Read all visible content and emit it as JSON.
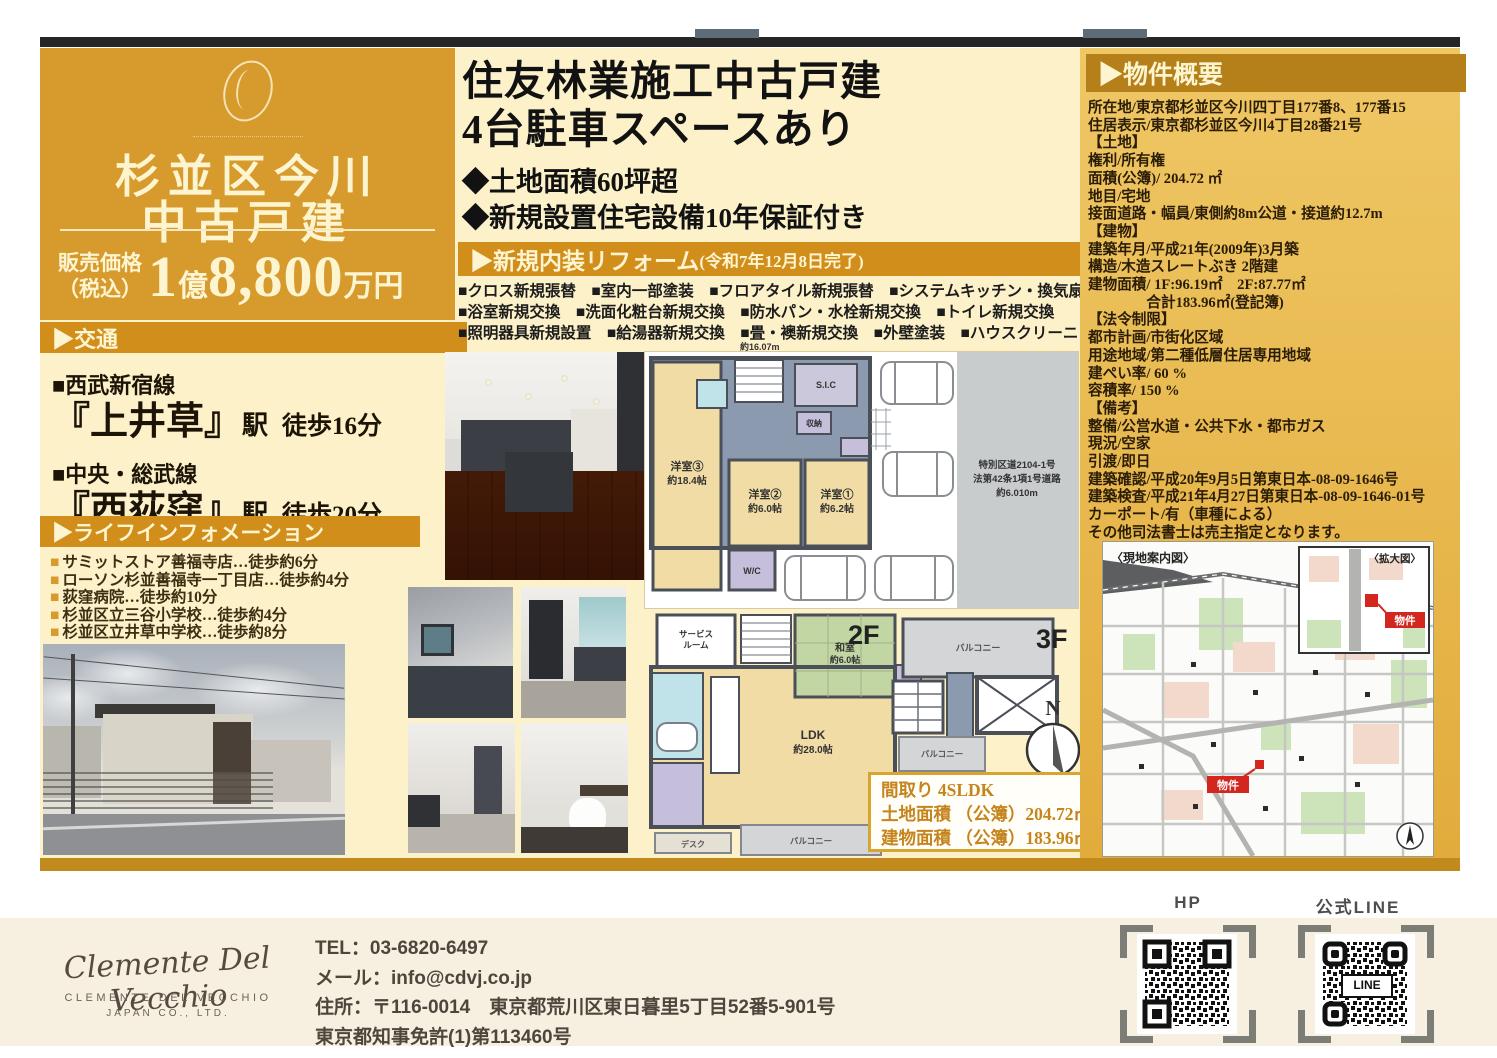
{
  "accent": {
    "gold_panel": "#d69a2d",
    "gold_bar": "#d18e1b",
    "gold_dark_bar": "#b5801a",
    "cream_bg": "#fcf1c8",
    "footer_bg": "#f7f0e1",
    "marker_red": "#d2261e"
  },
  "left": {
    "title_line1": "杉並区今川",
    "title_line2": "中古戸建",
    "price_label_1": "販売価格",
    "price_label_2": "（税込）",
    "price_num1": "1",
    "price_oku": "億",
    "price_num2": "8,800",
    "price_man": "万円",
    "traffic_header": "▶交通",
    "traffic": [
      {
        "line": "■西武新宿線",
        "station": "『上井草』",
        "suffix": "駅",
        "walk": "徒歩16分"
      },
      {
        "line": "■中央・総武線",
        "station": "『西荻窪』",
        "suffix": "駅",
        "walk": "徒歩20分"
      }
    ],
    "life_header": "▶ライフインフォメーション",
    "bullet": "■",
    "life_items": [
      "サミットストア善福寺店…徒歩約6分",
      "ローソン杉並善福寺一丁目店…徒歩約4分",
      "荻窪病院…徒歩約10分",
      "杉並区立三谷小学校…徒歩約4分",
      "杉並区立井草中学校…徒歩約8分"
    ]
  },
  "center": {
    "title1": "住友林業施工中古戸建",
    "title2": "4台駐車スペースあり",
    "point1": "◆土地面積60坪超",
    "point2": "◆新規設置住宅設備10年保証付き",
    "reform_header": "▶新規内装リフォーム",
    "reform_header_sub": "(令和7年12月8日完了)",
    "reform_lines": [
      "■クロス新規張替　■室内一部塗装　■フロアタイル新規張替　■システムキッチン・換気扇新規交換",
      "■浴室新規交換　■洗面化粧台新規交換　■防水パン・水栓新規交換　■トイレ新規交換",
      "■照明器具新規設置　■給湯器新規交換　■畳・襖新規交換　■外壁塗装　■ハウスクリーニング等"
    ],
    "plan1f": {
      "top_dim": "約16.07m",
      "room3": "洋室③",
      "room3_size": "約18.4帖",
      "room2": "洋室②",
      "room2_size": "約6.0帖",
      "room1": "洋室①",
      "room1_size": "約6.2帖",
      "wc": "W/C",
      "sic": "S.I.C",
      "closet": "収納",
      "road_text1": "特別区道2104-1号",
      "road_text2": "法第42条1項1号道路",
      "road_text3": "約6.010m"
    },
    "plan2f": {
      "label": "2F",
      "service1": "サービス",
      "service2": "ルーム",
      "washitsu": "和室",
      "washitsu_size": "約6.0帖",
      "ldk": "LDK",
      "ldk_size": "約28.0帖",
      "closet": "収納",
      "balcony": "バルコニー",
      "desk": "デスク"
    },
    "plan3f": {
      "label": "3F",
      "balcony_top": "バルコニー",
      "balcony_bottom": "バルコニー",
      "compass_n": "N"
    },
    "madori": {
      "line1": "間取り 4SLDK",
      "line2": "土地面積 （公簿）204.72㎡",
      "line3": "建物面積 （公簿）183.96㎡"
    }
  },
  "right": {
    "header": "▶物件概要",
    "lines": [
      "所在地/東京都杉並区今川四丁目177番8、177番15",
      "住居表示/東京都杉並区今川4丁目28番21号",
      "【土地】",
      "権利/所有権",
      "面積(公簿)/ 204.72 ㎡",
      "地目/宅地",
      "接面道路・幅員/東側約8m公道・接道約12.7m",
      "【建物】",
      "建築年月/平成21年(2009年)3月築",
      "構造/木造スレートぶき 2階建",
      "建物面積/ 1F:96.19㎡　2F:87.77㎡",
      "　　　　合計183.96㎡(登記簿)",
      "【法令制限】",
      "都市計画/市街化区域",
      "用途地域/第二種低層住居専用地域",
      "建ぺい率/ 60 %",
      "容積率/ 150 %",
      "【備考】",
      "整備/公営水道・公共下水・都市ガス",
      "現況/空家",
      "引渡/即日",
      "建築確認/平成20年9月5日第東日本-08-09-1646号",
      "建築検査/平成21年4月27日第東日本-08-09-1646-01号",
      "カーポート/有（車種による）",
      "その他司法書士は売主指定となります。"
    ],
    "map": {
      "label_main": "〈現地案内図〉",
      "label_inset": "〈拡大図〉",
      "marker1": "物件",
      "marker2": "物件"
    }
  },
  "footer": {
    "logo_script": "Clemente Del Vecchio",
    "logo_caps1": "CLEMENTE DEL VECCHIO",
    "logo_caps2": "JAPAN CO., LTD.",
    "tel": "TEL：03-6820-6497",
    "mail": "メール：info@cdvj.co.jp",
    "address": "住所：〒116-0014　東京都荒川区東日暮里5丁目52番5-901号",
    "license": "東京都知事免許(1)第113460号",
    "qr_hp_label": "HP",
    "qr_line_label": "公式LINE",
    "qr_line_text": "LINE"
  }
}
